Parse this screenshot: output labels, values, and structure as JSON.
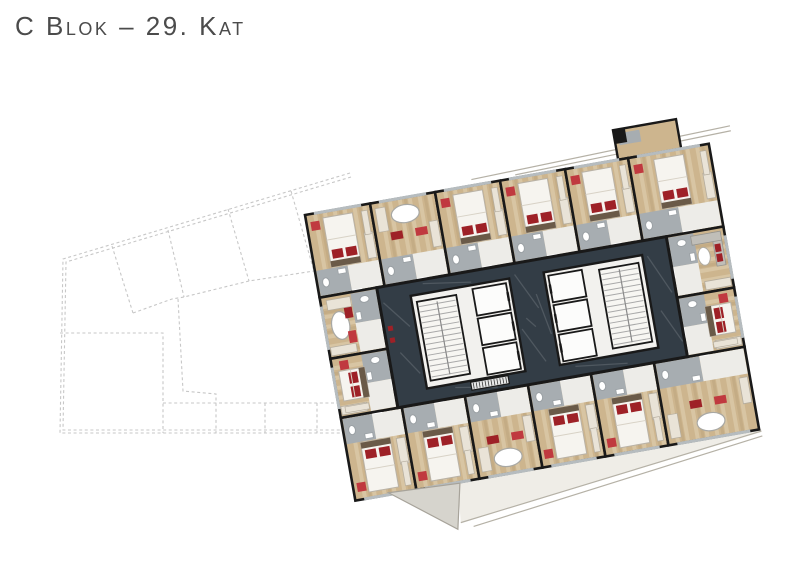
{
  "header": {
    "title": "C Blok – 29. Kat"
  },
  "palette": {
    "wall": "#191919",
    "core_floor": "#333d46",
    "core_block": "#f2f1ee",
    "stair_fill": "#f7f6f2",
    "lift_fill": "#fcfcfb",
    "wood": "#cdb58e",
    "wood_streak": "#e4d6b8",
    "wood_dark": "#b1976f",
    "bath_floor": "#a7adb1",
    "entry_floor": "#edece8",
    "bed_white": "#f6f4ef",
    "bed_stroke": "#b9b2a6",
    "headboard": "#6a5a48",
    "accent_red": "#9e2127",
    "accent_red2": "#c0393f",
    "window": "#b6bcbf",
    "closet": "#e9e3d7",
    "sofa": "#c0beb8",
    "terrace": "#d6d4cd",
    "terrace_line": "#b5b1a6",
    "balcony": "#efede7",
    "outline": "#c7c7c7",
    "vein": "rgba(255,255,255,0.14)"
  },
  "neighbor_outline": {
    "dash": "3 2.6",
    "stroke_width": 1.1,
    "lines": [
      [
        [
          350,
          173
        ],
        [
          63,
          259
        ],
        [
          60,
          433
        ],
        [
          368,
          433
        ]
      ],
      [
        [
          351,
          177
        ],
        [
          66,
          262
        ],
        [
          63,
          430
        ],
        [
          367,
          430
        ]
      ],
      [
        [
          112,
          246
        ],
        [
          133,
          313
        ]
      ],
      [
        [
          168,
          230
        ],
        [
          184,
          297
        ]
      ],
      [
        [
          228,
          209
        ],
        [
          249,
          281
        ]
      ],
      [
        [
          291,
          191
        ],
        [
          314,
          271
        ]
      ],
      [
        [
          133,
          313
        ],
        [
          172,
          299
        ],
        [
          184,
          297
        ],
        [
          249,
          281
        ],
        [
          314,
          271
        ],
        [
          358,
          263
        ]
      ],
      [
        [
          60,
          333
        ],
        [
          163,
          333
        ],
        [
          163,
          433
        ]
      ],
      [
        [
          178,
          299
        ],
        [
          183,
          391
        ],
        [
          216,
          394
        ],
        [
          216,
          433
        ]
      ],
      [
        [
          163,
          403
        ],
        [
          368,
          403
        ]
      ],
      [
        [
          265,
          403
        ],
        [
          265,
          433
        ]
      ],
      [
        [
          317,
          403
        ],
        [
          317,
          433
        ]
      ]
    ]
  },
  "tower": {
    "origin": [
      305,
      215
    ],
    "rotation": -10,
    "width": 410,
    "height": 290,
    "rows": {
      "top": {
        "y": 0,
        "h": 84,
        "door": "S",
        "rooms": [
          {
            "x": 0,
            "w": 66,
            "variant": "bed"
          },
          {
            "x": 66,
            "w": 66,
            "variant": "tub"
          },
          {
            "x": 132,
            "w": 66,
            "variant": "bed"
          },
          {
            "x": 198,
            "w": 66,
            "variant": "bed"
          },
          {
            "x": 264,
            "w": 64,
            "variant": "bed"
          },
          {
            "x": 328,
            "w": 82,
            "variant": "bed"
          }
        ]
      },
      "bottom": {
        "y": 206,
        "h": 84,
        "door": "N",
        "rooms": [
          {
            "x": 0,
            "w": 62,
            "variant": "bed"
          },
          {
            "x": 62,
            "w": 64,
            "variant": "bed"
          },
          {
            "x": 126,
            "w": 64,
            "variant": "tub"
          },
          {
            "x": 190,
            "w": 64,
            "variant": "bed"
          },
          {
            "x": 254,
            "w": 64,
            "variant": "bed"
          },
          {
            "x": 318,
            "w": 92,
            "variant": "tub"
          }
        ]
      },
      "left": {
        "x": 0,
        "w": 58,
        "door": "E",
        "rooms": [
          {
            "y": 84,
            "h": 62,
            "variant": "tub"
          },
          {
            "y": 146,
            "h": 60,
            "variant": "bed"
          }
        ]
      },
      "right": {
        "x": 352,
        "w": 58,
        "door": "W",
        "rooms": [
          {
            "y": 84,
            "h": 62,
            "variant": "living"
          },
          {
            "y": 146,
            "h": 60,
            "variant": "bed"
          }
        ]
      }
    },
    "annex": {
      "x": 318,
      "y": -30,
      "w": 64,
      "h": 30
    },
    "core": {
      "x": 58,
      "y": 84,
      "w": 294,
      "h": 122,
      "veins": [
        [
          62,
          100,
          84,
          128
        ],
        [
          70,
          152,
          86,
          176
        ],
        [
          196,
          95,
          214,
          132
        ],
        [
          194,
          150,
          212,
          186
        ],
        [
          214,
          118,
          222,
          160
        ],
        [
          330,
          100,
          348,
          140
        ],
        [
          334,
          156,
          350,
          190
        ],
        [
          104,
          88,
          152,
          95
        ],
        [
          240,
          196,
          292,
          202
        ],
        [
          118,
          196,
          160,
          203
        ],
        [
          200,
          140,
          208,
          150
        ]
      ],
      "blocks": [
        {
          "x": 90,
          "y": 98,
          "w": 100,
          "h": 94,
          "stair": {
            "x": 95,
            "y": 105,
            "w": 40,
            "h": 80
          },
          "lifts": {
            "x": 152,
            "w": 34,
            "cells": [
              [
                102,
                27
              ],
              [
                132,
                27
              ],
              [
                162,
                27
              ]
            ],
            "door": "E"
          }
        },
        {
          "x": 225,
          "y": 98,
          "w": 100,
          "h": 94,
          "stair": {
            "x": 280,
            "y": 105,
            "w": 40,
            "h": 80
          },
          "lifts": {
            "x": 229,
            "w": 34,
            "cells": [
              [
                102,
                27
              ],
              [
                132,
                27
              ],
              [
                162,
                27
              ]
            ],
            "door": "W"
          }
        }
      ],
      "mat": {
        "x": 134,
        "y": 193.5,
        "w": 38,
        "h": 8
      },
      "dots": [
        [
          62,
          124
        ],
        [
          62,
          136
        ]
      ]
    },
    "terrace": {
      "wedge": [
        [
          34,
          288
        ],
        [
          106,
          291
        ],
        [
          96,
          336
        ]
      ],
      "strip": [
        [
          104,
          290
        ],
        [
          412,
          290
        ],
        [
          412,
          293
        ],
        [
          100,
          330
        ]
      ],
      "rails": [
        [
          [
            100,
            330
          ],
          [
            412,
            292
          ]
        ],
        [
          [
            112,
            336
          ],
          [
            412,
            297
          ]
        ]
      ],
      "top_rails": [
        [
          [
            170,
            -6
          ],
          [
            434,
            -14
          ]
        ],
        [
          [
            214,
            -3
          ],
          [
            434,
            -9
          ]
        ]
      ]
    }
  }
}
